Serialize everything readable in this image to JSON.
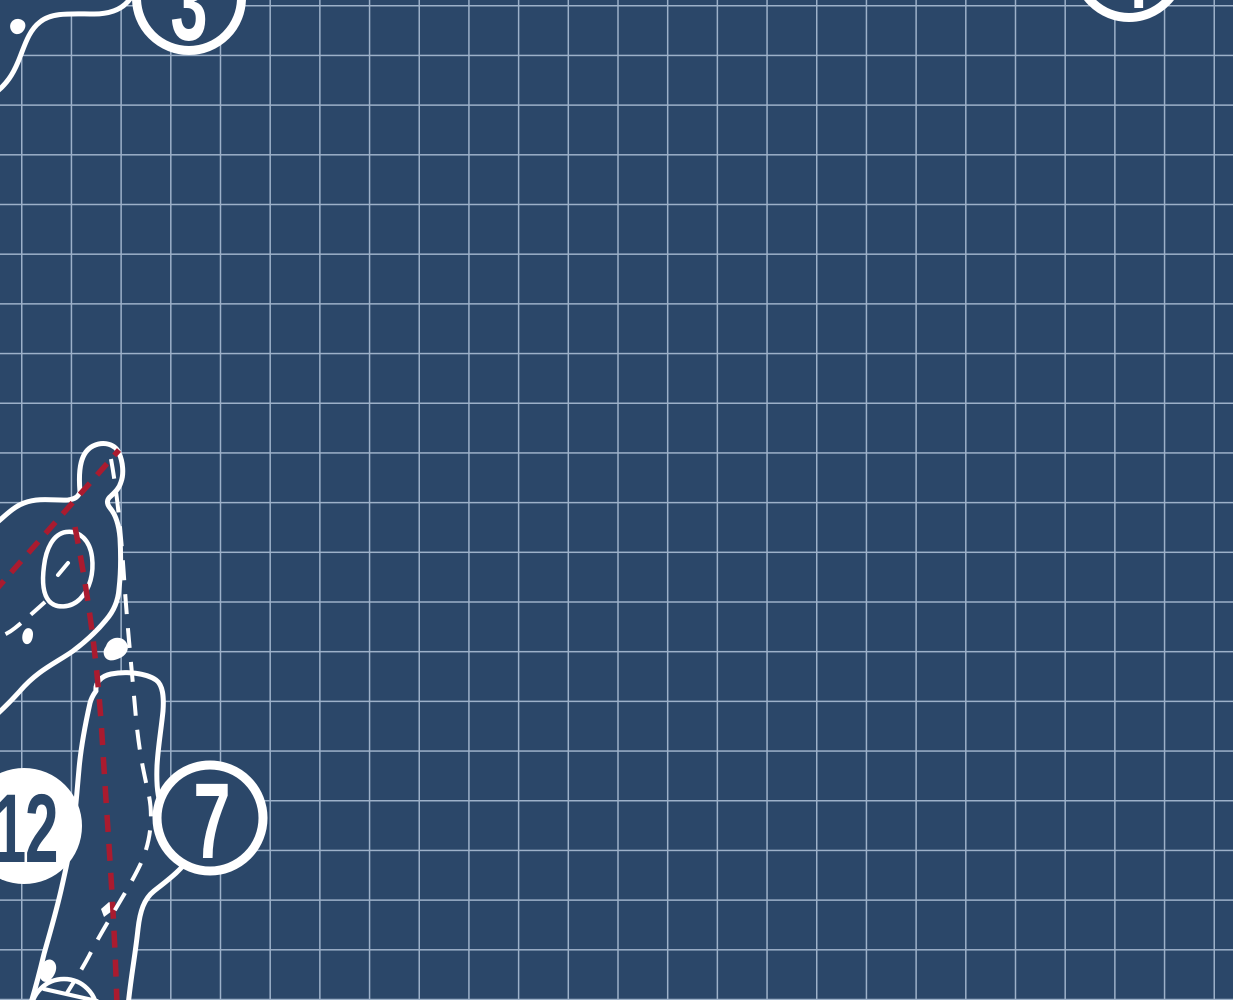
{
  "colors": {
    "bg_navy": "#2b4769",
    "grid_line": "#9db1c9",
    "line_white": "#ffffff",
    "hazard_red": "#aa1b2f"
  },
  "grid": {
    "cell_size_px": 49.7,
    "offset_x_px": 21,
    "offset_y_px": 5
  },
  "hole_markers": [
    {
      "number": "3",
      "style": "outline-ring"
    },
    {
      "number": "4",
      "style": "outline-ring"
    },
    {
      "number": "12",
      "style": "filled"
    },
    {
      "number": "7",
      "style": "outline-ring"
    }
  ]
}
